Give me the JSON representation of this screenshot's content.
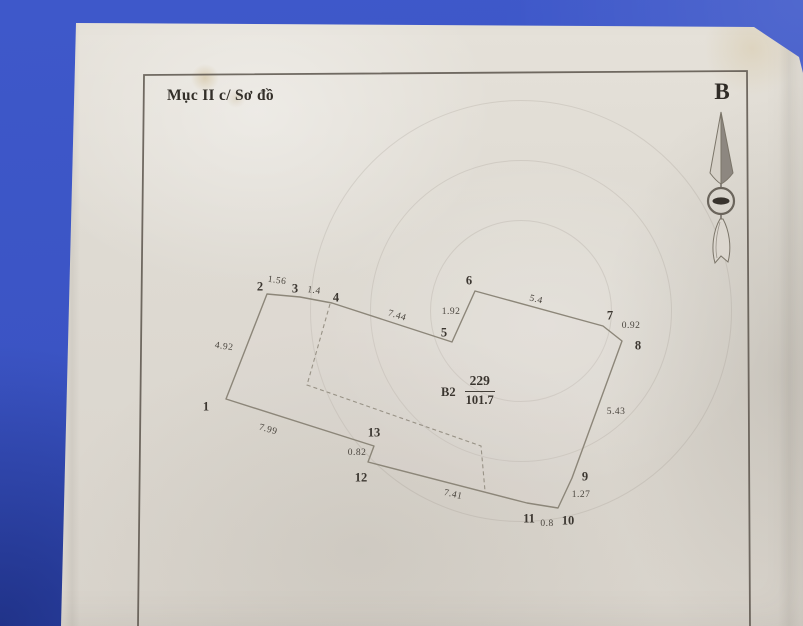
{
  "page": {
    "title": "Mục II c/ Sơ đồ",
    "compass_letter": "B"
  },
  "parcel": {
    "block_label": "B2",
    "numerator": "229",
    "denominator": "101.7"
  },
  "colors": {
    "background_blue": "#3b54c4",
    "paper": "#ddd8d0",
    "frame_line": "#5a544b",
    "drawing_line": "#8f897f",
    "text": "#45403e"
  },
  "diagram": {
    "outline": [
      [
        226,
        399
      ],
      [
        267,
        294
      ],
      [
        300,
        297
      ],
      [
        332,
        303
      ],
      [
        452,
        342
      ],
      [
        475,
        291
      ],
      [
        603,
        326
      ],
      [
        622,
        341
      ],
      [
        572,
        478
      ],
      [
        558,
        508
      ],
      [
        527,
        503
      ],
      [
        368,
        462
      ],
      [
        374,
        446
      ]
    ],
    "interior_dashed": [
      [
        330,
        304
      ],
      [
        307,
        385
      ],
      [
        481,
        446
      ],
      [
        485,
        491
      ]
    ],
    "vertex_labels": [
      {
        "n": "1",
        "x": 206,
        "y": 407
      },
      {
        "n": "2",
        "x": 260,
        "y": 287
      },
      {
        "n": "3",
        "x": 295,
        "y": 289
      },
      {
        "n": "4",
        "x": 336,
        "y": 298
      },
      {
        "n": "5",
        "x": 444,
        "y": 333
      },
      {
        "n": "6",
        "x": 469,
        "y": 281
      },
      {
        "n": "7",
        "x": 610,
        "y": 316
      },
      {
        "n": "8",
        "x": 638,
        "y": 346
      },
      {
        "n": "9",
        "x": 585,
        "y": 477
      },
      {
        "n": "10",
        "x": 568,
        "y": 521
      },
      {
        "n": "11",
        "x": 529,
        "y": 519
      },
      {
        "n": "12",
        "x": 361,
        "y": 478
      },
      {
        "n": "13",
        "x": 374,
        "y": 433
      }
    ],
    "edge_labels": [
      {
        "text": "1.56",
        "x": 277,
        "y": 281,
        "rot": 8
      },
      {
        "text": "1.4",
        "x": 314,
        "y": 291,
        "rot": 8
      },
      {
        "text": "7.44",
        "x": 397,
        "y": 316,
        "rot": 17
      },
      {
        "text": "1.92",
        "x": 451,
        "y": 312,
        "rot": 0
      },
      {
        "text": "5.4",
        "x": 536,
        "y": 300,
        "rot": 14
      },
      {
        "text": "0.92",
        "x": 631,
        "y": 326,
        "rot": 0
      },
      {
        "text": "5.43",
        "x": 616,
        "y": 412,
        "rot": 0
      },
      {
        "text": "1.27",
        "x": 581,
        "y": 495,
        "rot": 0
      },
      {
        "text": "0.8",
        "x": 547,
        "y": 524,
        "rot": 0
      },
      {
        "text": "7.41",
        "x": 453,
        "y": 495,
        "rot": 13
      },
      {
        "text": "0.82",
        "x": 357,
        "y": 453,
        "rot": 0
      },
      {
        "text": "7.99",
        "x": 268,
        "y": 430,
        "rot": 16
      },
      {
        "text": "4.92",
        "x": 224,
        "y": 347,
        "rot": 8
      }
    ]
  }
}
